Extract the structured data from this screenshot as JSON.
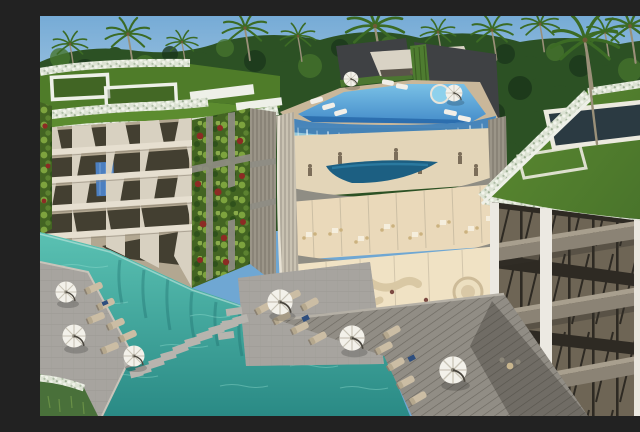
{
  "meta": {
    "type": "3d-architectural-rendering",
    "subject": "Tropical resort condominium complex",
    "view": "aerial three-quarter view",
    "description": "Aerial 3D rendering of a luxury tropical resort: two modern residence buildings with green roofs and white flowering hedge borders, a central multi-level clubhouse with a glass-edge rooftop infinity pool whose water sheets down a curved glass facade, vertical living garden walls dotted with red blooms, and a turquoise lagoon pool at ground level with grey sun decks, stepping stones, white parasols and beige sun loungers, all surrounded by dense coconut-palm jungle under a blue sky."
  },
  "colors": {
    "sky-top": "#76abd6",
    "sky-horizon": "#b8d4e6",
    "distant-hills": "#4c6a4e",
    "jungle-dark": "#1c371b",
    "jungle-mid": "#2c5124",
    "jungle-light": "#47762e",
    "palm-frond": "#3c6b25",
    "palm-trunk": "#9a9079",
    "lawn-green": "#4f7c29",
    "lawn-light": "#5c8c2f",
    "hedge-white": "#dde3d4",
    "parapet-white": "#eef0e8",
    "facade-shadow": "#b2a791",
    "column-cream": "#d8d1c1",
    "window-dark": "#433f31",
    "slab-light": "#e6dfd0",
    "feature-glass-blue": "#4c7fc0",
    "living-wall-green": "#436422",
    "living-wall-light": "#7da33e",
    "living-wall-red": "#8c2b24",
    "concrete-gray": "#8f8d84",
    "slat-wall": "#9b9588",
    "pool-deck-beige": "#c9b79a",
    "pavilion-dark": "#3f4144",
    "canopy-cream": "#d9d3c5",
    "hanging-plants": "#4e7c30",
    "pool-blue": "#3e86c6",
    "pool-light": "#7fc6e9",
    "pool-tile": "#2566a8",
    "glass-edge-blue": "#8fcdea",
    "glass-edge-pale": "#cfeaf6",
    "waterfall-white": "#f2fbff",
    "interior-warm": "#e3d5b8",
    "interior-lit": "#f0e2c4",
    "figure-dark": "#6b5d4a",
    "terrace-pool-teal": "#1c5f82",
    "sofa-cream": "#d9c8a4",
    "daybed-cream": "#ecdfc0",
    "shell-cream": "#c9c2b2",
    "right-window": "#6e6555",
    "right-frame": "#2e2a23",
    "right-slab": "#8b8375",
    "right-slab-top": "#a89f8e",
    "right-pier-white": "#ece9e2",
    "lagoon-light": "#5cc3b4",
    "lagoon-deep": "#2a8a85",
    "ripple": "#96e0d2",
    "reflection-dark": "#1d6b6b",
    "deck-gray": "#a9a7a2",
    "wood-deck": "#918d85",
    "stone-path": "#b7b4ae",
    "stone-base": "#d8cbaa",
    "grass-corner": "#49703a",
    "umbrella-white": "#f3f1ea",
    "umbrella-rib": "#c9c4b6",
    "lounger-beige": "#cbbda4",
    "towel-blue": "#2e4e7e",
    "shadow": "#33302a"
  },
  "scene": {
    "background": {
      "sky": "clear blue",
      "vegetation": "dense tropical jungle treeline",
      "palm_count": 13
    },
    "left_building": {
      "label": "left residence building",
      "floors": 4,
      "features": [
        "rooftop lawn gardens",
        "white flower hedge borders",
        "white rooftop skylight frames",
        "zigzag cream facade columns",
        "balcony slabs",
        "blue glass feature panel",
        "vertical living wall with red flowers",
        "slatted side tower"
      ]
    },
    "central_building": {
      "label": "clubhouse tower",
      "levels": [
        "rooftop pool deck with dark pavilion and cream canopy",
        "gym level with guests",
        "terrace lens pool",
        "restaurant level with dining tables",
        "lobby lounge"
      ],
      "features": [
        "glass-edge infinity pool",
        "water cascading over curved glass",
        "round spa pool",
        "serpentine cream sofas",
        "round daybed"
      ]
    },
    "right_building": {
      "label": "right residence building",
      "floors": 3,
      "features": [
        "sloped green roof",
        "white flower border",
        "white-framed roof skylight",
        "white vertical piers",
        "grey balcony slabs",
        "windows with diagonal mullions"
      ]
    },
    "ground": {
      "water": "turquoise lagoon pool",
      "deck_count": 3,
      "stepping_stones": 11,
      "umbrellas": 8,
      "loungers": 24,
      "extras": [
        "blue pool towels",
        "bistro chair set",
        "grass corner with white flowers",
        "steps into water"
      ]
    }
  }
}
